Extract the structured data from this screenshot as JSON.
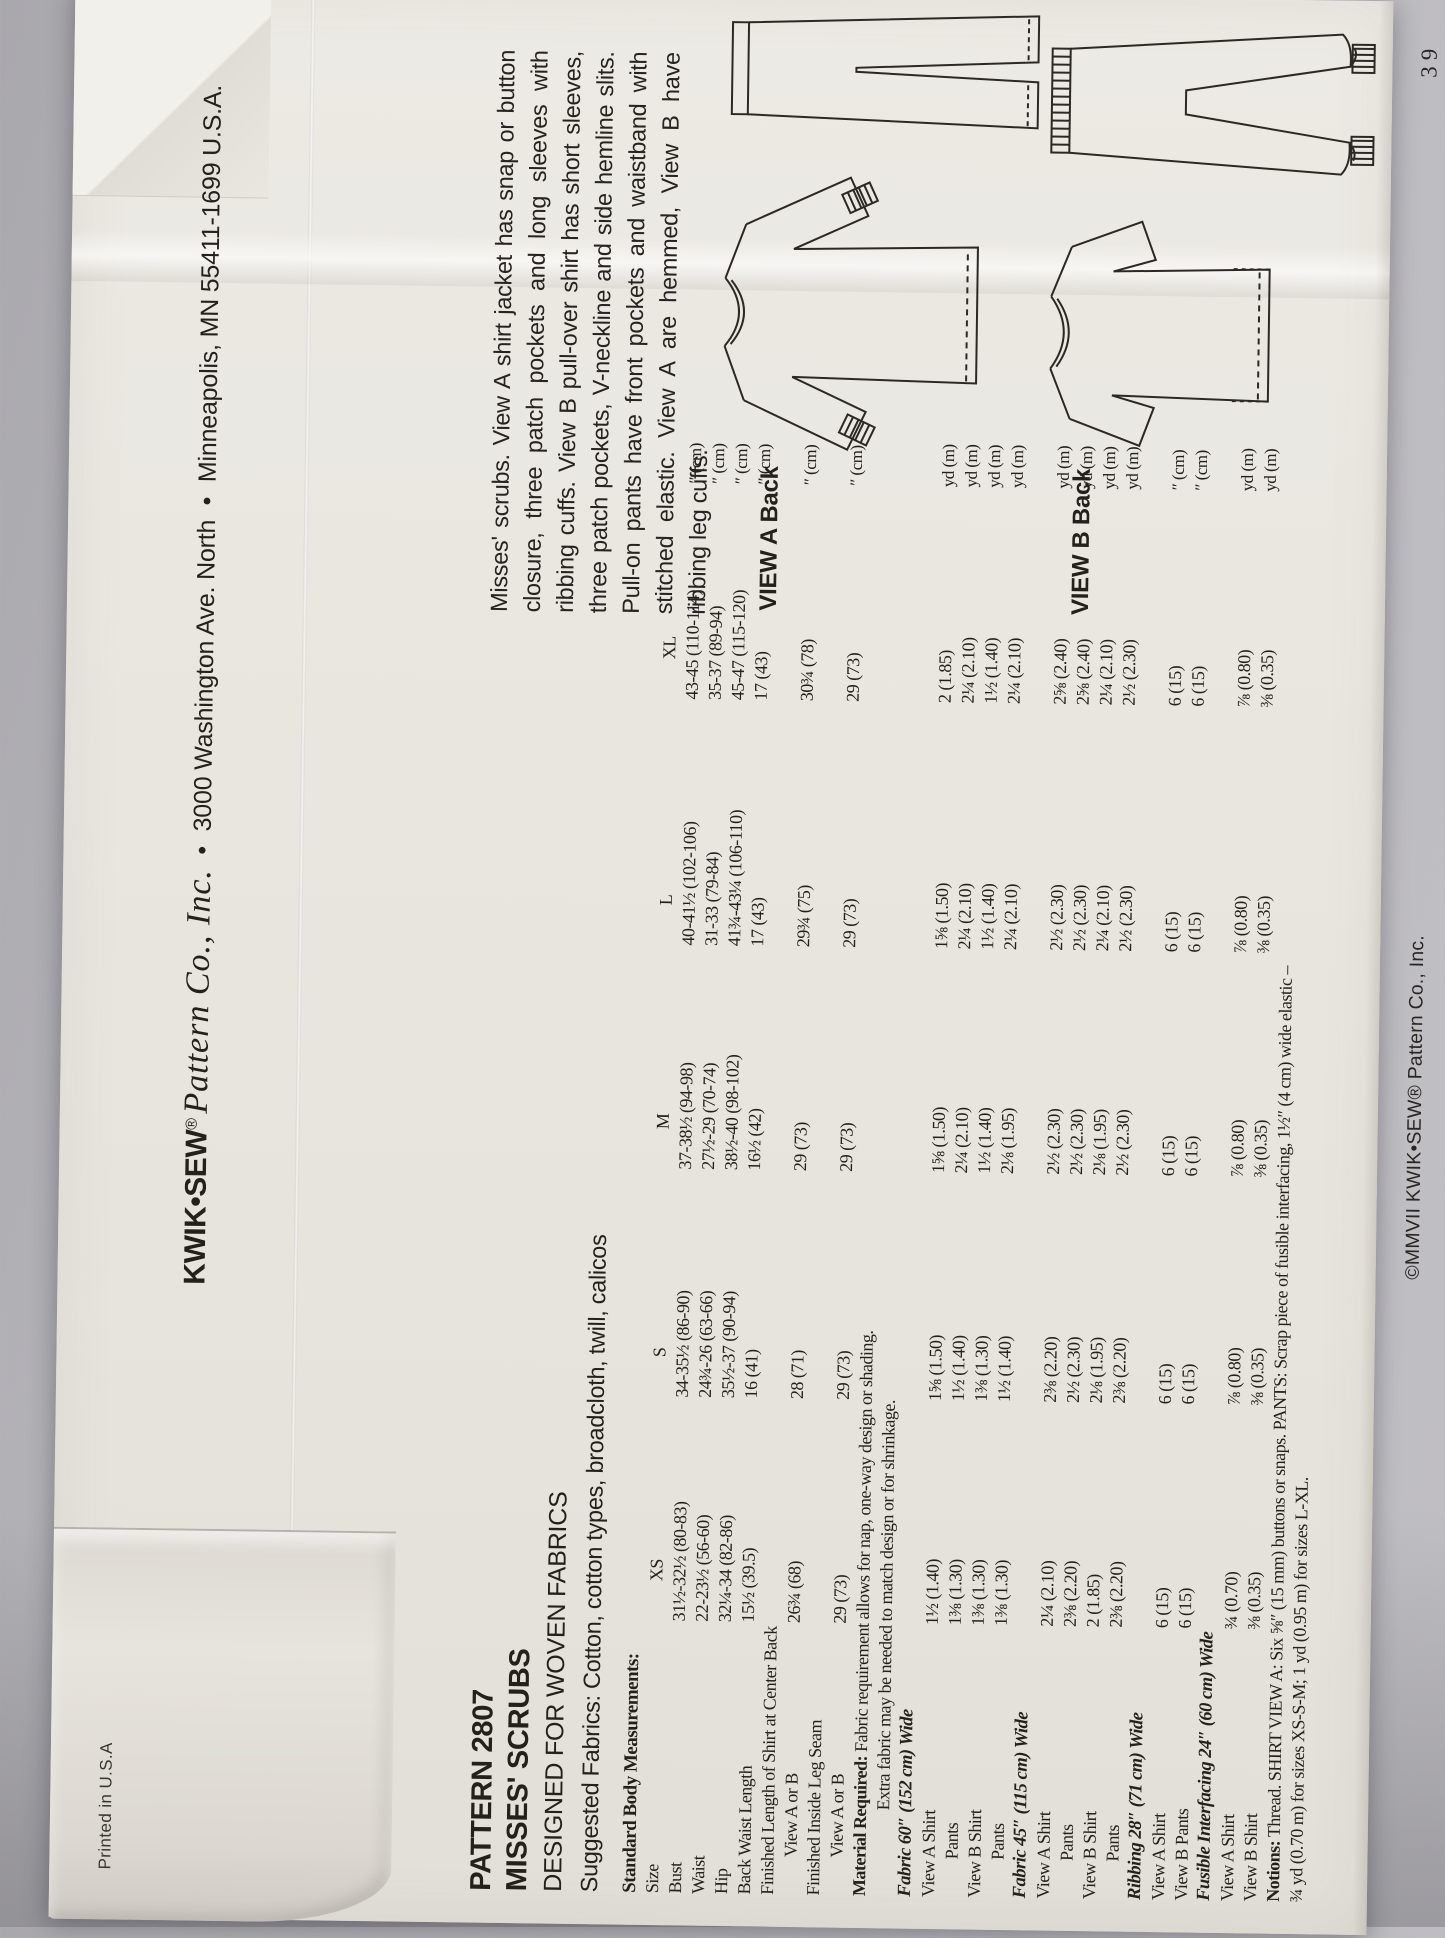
{
  "colors": {
    "paper": "#e9e6e0",
    "background": "#b6b5ba",
    "ink": "#24211d"
  },
  "header": {
    "brand": "KWIK•SEW",
    "registered": "®",
    "script_name": "Pattern Co., Inc.",
    "bullet": "•",
    "address_street": "3000 Washington Ave. North",
    "address_city": "Minneapolis, MN 55411-1699 U.S.A."
  },
  "title_block": {
    "pattern": "PATTERN 2807",
    "name": "MISSES' SCRUBS",
    "designed": "DESIGNED FOR WOVEN FABRICS",
    "suggested": "Suggested Fabrics: Cotton, cotton types, broadcloth, twill, calicos"
  },
  "description": "Misses' scrubs. View A shirt jacket has snap or button closure, three patch pockets and long sleeves with ribbing cuffs. View B pull-over shirt has short sleeves, three patch pockets, V-neckline and side hemline slits. Pull-on pants have front pockets and waistband with stitched elastic. View A are hemmed, View B have ribbing leg cuffs.",
  "views": {
    "view_a_label": "VIEW A Back",
    "view_b_label": "VIEW B Back"
  },
  "measurements": {
    "sizes": [
      "XS",
      "S",
      "M",
      "L",
      "XL"
    ],
    "rows": [
      {
        "label": "Standard Body Measurements:",
        "style": "heading"
      },
      {
        "label": "Size",
        "style": "size",
        "values": [
          "XS",
          "S",
          "M",
          "L",
          "XL"
        ],
        "unit": ""
      },
      {
        "label": "Bust",
        "values": [
          "31½-32½ (80-83)",
          "34-35½ (86-90)",
          "37-38½ (94-98)",
          "40-41½ (102-106)",
          "43-45 (110-114)"
        ],
        "unit": "″ (cm)"
      },
      {
        "label": "Waist",
        "values": [
          "22-23½ (56-60)",
          "24¾-26 (63-66)",
          "27½-29 (70-74)",
          "31-33 (79-84)",
          "35-37 (89-94)"
        ],
        "unit": "″ (cm)"
      },
      {
        "label": "Hip",
        "values": [
          "32¼-34 (82-86)",
          "35½-37 (90-94)",
          "38½-40 (98-102)",
          "41¾-43¼ (106-110)",
          "45-47 (115-120)"
        ],
        "unit": "″ (cm)"
      },
      {
        "label": "Back Waist Length",
        "values": [
          "15½ (39.5)",
          "16 (41)",
          "16½ (42)",
          "17 (43)",
          "17 (43)"
        ],
        "unit": "″ (cm)"
      },
      {
        "label": "Finished Length of Shirt at Center Back"
      },
      {
        "label": "View A or B",
        "indent": 1,
        "values": [
          "26¾ (68)",
          "28 (71)",
          "29 (73)",
          "29¾ (75)",
          "30¾ (78)"
        ],
        "unit": "″ (cm)"
      },
      {
        "label": "Finished Inside Leg Seam"
      },
      {
        "label": "View A or B",
        "indent": 1,
        "values": [
          "29 (73)",
          "29 (73)",
          "29 (73)",
          "29 (73)",
          "29 (73)"
        ],
        "unit": "″ (cm)"
      },
      {
        "label_bold": "Material Required:",
        "label": " Fabric requirement allows for nap, one-way design or shading."
      },
      {
        "label": "Extra fabric may be needed to match design or for shrinkage.",
        "indent": 2
      },
      {
        "label": "Fabric 60″ (152 cm) Wide",
        "style": "section"
      },
      {
        "label": "View A Shirt",
        "values": [
          "1½ (1.40)",
          "1⅝ (1.50)",
          "1⅝ (1.50)",
          "1⅝ (1.50)",
          "2 (1.85)"
        ],
        "unit": "yd (m)"
      },
      {
        "label": "Pants",
        "indent": 1,
        "values": [
          "1⅜ (1.30)",
          "1½ (1.40)",
          "2¼ (2.10)",
          "2¼ (2.10)",
          "2¼ (2.10)"
        ],
        "unit": "yd (m)"
      },
      {
        "label": "View B Shirt",
        "values": [
          "1⅜ (1.30)",
          "1⅜ (1.30)",
          "1½ (1.40)",
          "1½ (1.40)",
          "1½ (1.40)"
        ],
        "unit": "yd (m)"
      },
      {
        "label": "Pants",
        "indent": 1,
        "values": [
          "1⅜ (1.30)",
          "1½ (1.40)",
          "2⅛ (1.95)",
          "2¼ (2.10)",
          "2¼ (2.10)"
        ],
        "unit": "yd (m)"
      },
      {
        "label": "Fabric 45″ (115 cm) Wide",
        "style": "section"
      },
      {
        "label": "View A Shirt",
        "values": [
          "2¼ (2.10)",
          "2⅜ (2.20)",
          "2½ (2.30)",
          "2½ (2.30)",
          "2⅝ (2.40)"
        ],
        "unit": "yd (m)"
      },
      {
        "label": "Pants",
        "indent": 1,
        "values": [
          "2⅜ (2.20)",
          "2½ (2.30)",
          "2½ (2.30)",
          "2½ (2.30)",
          "2⅝ (2.40)"
        ],
        "unit": "yd (m)"
      },
      {
        "label": "View B Shirt",
        "values": [
          "2 (1.85)",
          "2⅛ (1.95)",
          "2⅛ (1.95)",
          "2¼ (2.10)",
          "2¼ (2.10)"
        ],
        "unit": "yd (m)"
      },
      {
        "label": "Pants",
        "indent": 1,
        "values": [
          "2⅜ (2.20)",
          "2⅜ (2.20)",
          "2½ (2.30)",
          "2½ (2.30)",
          "2½ (2.30)"
        ],
        "unit": "yd (m)"
      },
      {
        "label": "Ribbing 28″ (71 cm) Wide",
        "style": "section"
      },
      {
        "label": "View A Shirt",
        "values": [
          "6 (15)",
          "6 (15)",
          "6 (15)",
          "6 (15)",
          "6 (15)"
        ],
        "unit": "″ (cm)"
      },
      {
        "label": "View B Pants",
        "values": [
          "6 (15)",
          "6 (15)",
          "6 (15)",
          "6 (15)",
          "6 (15)"
        ],
        "unit": "″ (cm)"
      },
      {
        "label": "Fusible Interfacing 24″ (60 cm) Wide",
        "style": "section"
      },
      {
        "label": "View A Shirt",
        "values": [
          "¾ (0.70)",
          "⅞ (0.80)",
          "⅞ (0.80)",
          "⅞ (0.80)",
          "⅞ (0.80)"
        ],
        "unit": "yd (m)"
      },
      {
        "label": "View B Shirt",
        "values": [
          "⅜ (0.35)",
          "⅜ (0.35)",
          "⅜ (0.35)",
          "⅜ (0.35)",
          "⅜ (0.35)"
        ],
        "unit": "yd (m)"
      },
      {
        "label_bold": "Notions:",
        "label": " Thread. SHIRT VIEW A: Six ⅝″ (15 mm) buttons or snaps. PANTS: Scrap piece of fusible interfacing, 1½″ (4 cm) wide elastic –"
      },
      {
        "label": "¾ yd (0.70 m) for sizes XS-S-M; 1 yd (0.95 m) for sizes L-XL."
      }
    ]
  },
  "footer": {
    "copyright": "©MMVII KWIK•SEW® Pattern Co., Inc.",
    "page_number": "39",
    "printed_in": "Printed in U.S.A"
  }
}
